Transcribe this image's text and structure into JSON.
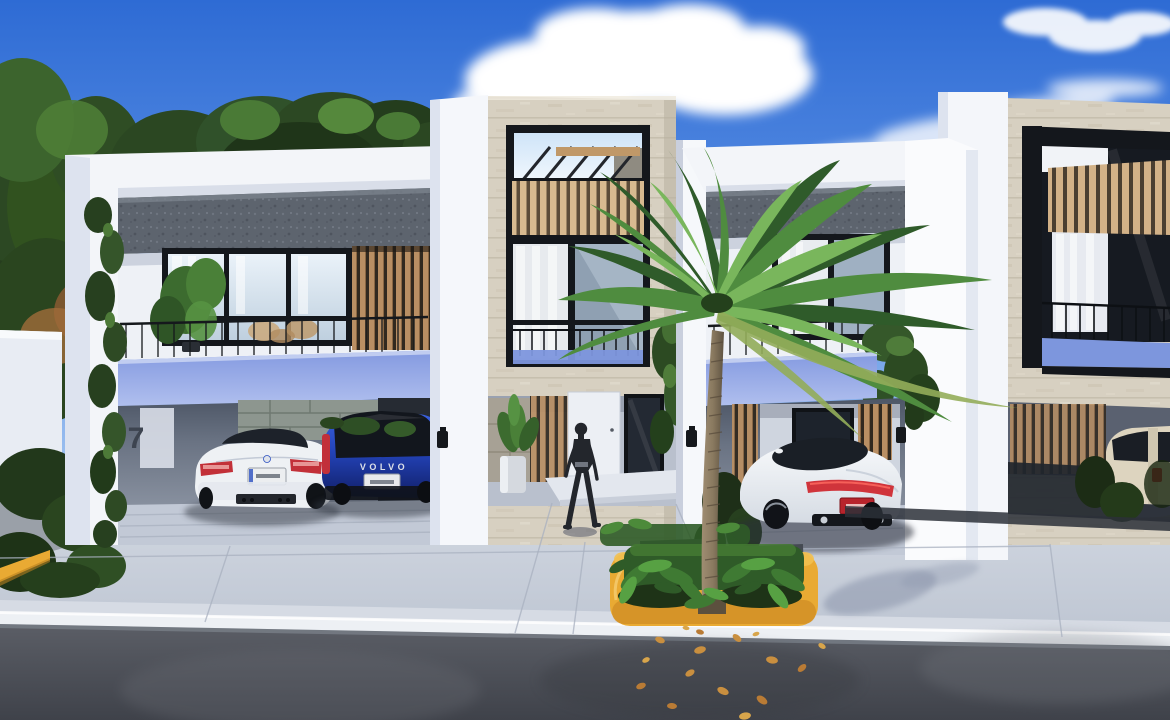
{
  "scene": {
    "title": "Modern townhouse row — exterior architectural 3D rendering",
    "setting": "daytime, clear blue sky with scattered clouds, tropical street",
    "house_number": "7",
    "labels": {
      "volvo_badge": "VOLVO"
    },
    "objects": [
      {
        "name": "unit-1",
        "desc": "white-frame townhouse, gray concrete band, glass window wall, wood slats, balcony with periwinkle fascia, double carport"
      },
      {
        "name": "unit-2",
        "desc": "travertine stone tower, rooftop terrace with pergola and wood-slat railing, picture window, recessed entrance with white door"
      },
      {
        "name": "unit-3",
        "desc": "white-frame townhouse with gray band, balcony, periwinkle fascia, single carport"
      },
      {
        "name": "unit-4",
        "desc": "partial stone-facade unit with large black-framed opening, wood slats and carport"
      },
      {
        "name": "white-coupe",
        "desc": "white coupe parked in left carport"
      },
      {
        "name": "blue-hatchback",
        "desc": "blue hatchback parked in left carport"
      },
      {
        "name": "white-sports-car",
        "desc": "white sports sedan parked in right carport"
      },
      {
        "name": "cream-suv",
        "desc": "cream SUV partially visible in far-right carport"
      },
      {
        "name": "pedestrian",
        "desc": "woman walking toward the center entrance"
      },
      {
        "name": "palm-tree",
        "desc": "tall palm in yellow-curbed street median"
      },
      {
        "name": "median-planter",
        "desc": "yellow painted curb, grass and tropical plants"
      },
      {
        "name": "street",
        "desc": "dark asphalt road with scattered fallen leaves, white curb, light concrete driveway"
      },
      {
        "name": "trees",
        "desc": "dense green trees behind the left unit, climbing vines on columns"
      }
    ],
    "colors": {
      "sky_top": "#2e6bd4",
      "sky_mid": "#6397e7",
      "sky_horizon": "#b7d3f3",
      "stone": "#d7d0c1",
      "concrete_band": "#5d646e",
      "wood": "#b98f63",
      "wood_light": "#d8ba90",
      "fascia_top": "#8399e0",
      "fascia_bottom": "#b0bfee",
      "driveway_light": "#d8dde6",
      "driveway_dark": "#bcc4d1",
      "road_light": "#5a5d65",
      "road_dark": "#3f424a",
      "curb_yellow": "#e9aa33",
      "palm_trunk": "#8a7a60",
      "palm_green": "#4f8c3f",
      "palm_dark": "#2f5b2a",
      "palm_light": "#79b65c",
      "car_white": "#eef1f4",
      "car_blue": "#2343b8",
      "car_cream": "#ddd4bf",
      "tail_red": "#c2303a",
      "person": "#23262c",
      "grass": "#2f5b28",
      "leaf_orange": "#c98f3f",
      "wall_white": "#f3f5f9",
      "glass_light": "#e3ecf4",
      "frame_black": "#14171c"
    }
  }
}
